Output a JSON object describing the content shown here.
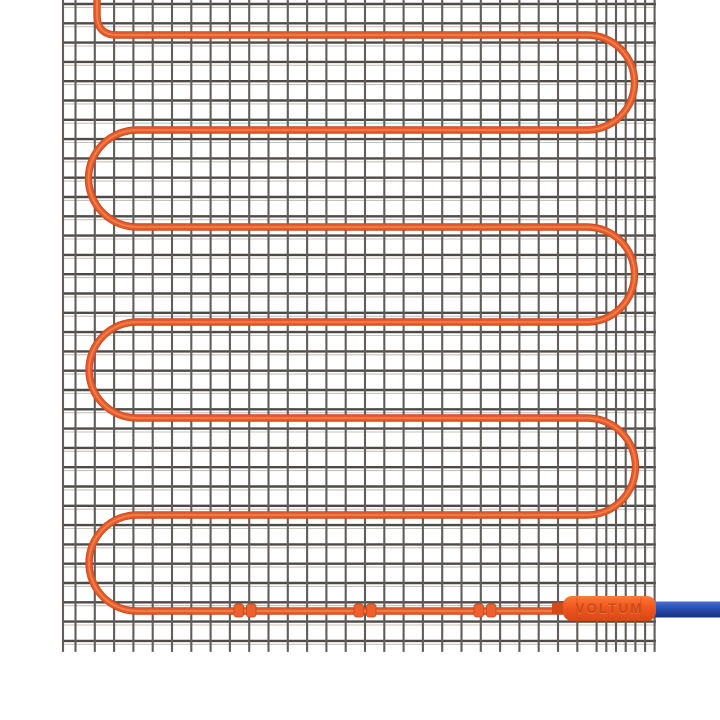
{
  "connector": {
    "label": "VOLTUM",
    "x": 563,
    "y": 596,
    "width": 93,
    "height": 25,
    "corner_radius": 9,
    "sleeve": {
      "x": 552,
      "y": 602.5,
      "width": 14,
      "height": 12
    },
    "seam_xs": [
      577,
      641
    ]
  },
  "colors": {
    "background": "#ffffff",
    "mesh_h_line": "#4e4a47",
    "mesh_h_shadow": "#c8c2bc",
    "mesh_v_line": "#615d5a",
    "cable_edge": "#c9481e",
    "cable_main": "#e65a2b",
    "cable_highlight": "#f0804a",
    "clip_fill": "#ee5f2e",
    "clip_stroke": "#c7481c",
    "connector_top": "#f97a3c",
    "connector_mid": "#f1561e",
    "connector_bottom": "#d44918",
    "connector_text": "#b84310",
    "connector_text_glow": "#ff9b66",
    "lead_top": "#4a6ed2",
    "lead_mid": "#2a51b4",
    "lead_bottom": "#16317f"
  },
  "mesh": {
    "x": 62,
    "right": 656,
    "top": 0,
    "cell": 19.3,
    "first_hline_y": 4,
    "hline_count": 34,
    "first_vline_x": 75.5,
    "vline_count": 28,
    "extra_vlines_x": [
      63,
      606.3,
      616.0,
      625.7,
      635.4,
      645.1,
      654.6
    ],
    "vline_bottom_overhang": 11,
    "h_shadow_offset": 3.4
  },
  "cable": {
    "entry_x": 97,
    "entry_curve_radius": 20,
    "row_ys": [
      35,
      130,
      227,
      322,
      418,
      515,
      611
    ],
    "run_left_x": 137,
    "run_right_x": 587,
    "end_x": 574,
    "width_outer": 7.4,
    "width_main": 5.6,
    "width_highlight": 1.8
  },
  "clips": {
    "positions_x": [
      245,
      365,
      485
    ],
    "center_y": 610.5,
    "half_w": 9.5,
    "half_h": 6.5,
    "gap": 3
  },
  "lead": {
    "x": 650,
    "y": 601.5,
    "width": 70,
    "height": 16
  }
}
